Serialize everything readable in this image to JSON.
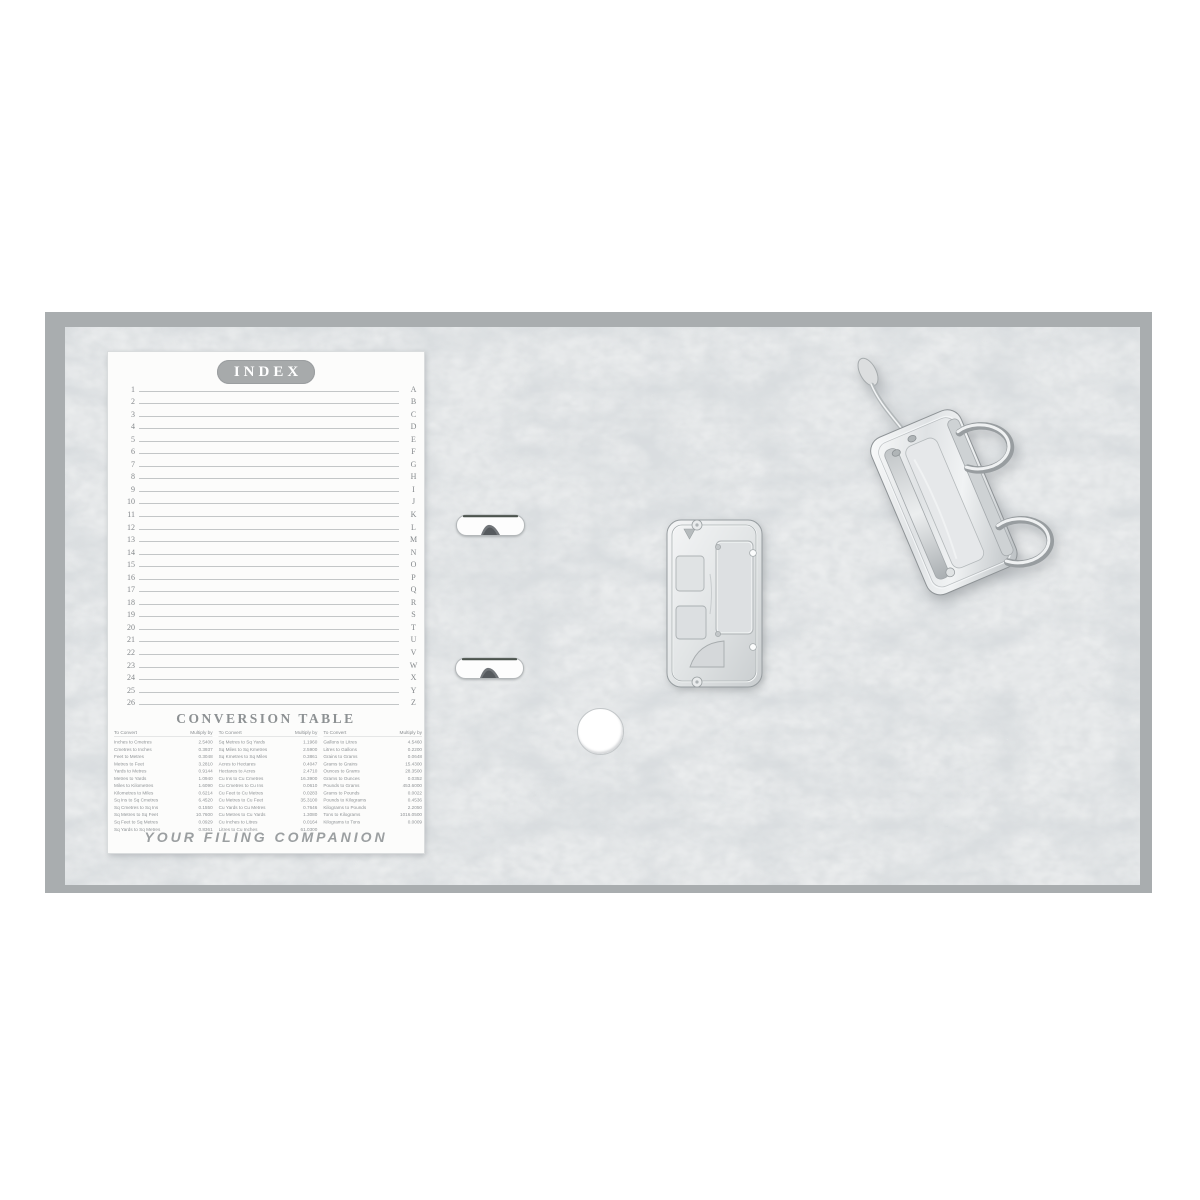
{
  "binder": {
    "index_card": {
      "title": "INDEX",
      "row_numbers": [
        "1",
        "2",
        "3",
        "4",
        "5",
        "6",
        "7",
        "8",
        "9",
        "10",
        "11",
        "12",
        "13",
        "14",
        "15",
        "16",
        "17",
        "18",
        "19",
        "20",
        "21",
        "22",
        "23",
        "24",
        "25",
        "26"
      ],
      "letters": [
        "A",
        "B",
        "C",
        "D",
        "E",
        "F",
        "G",
        "H",
        "I",
        "J",
        "K",
        "L",
        "M",
        "N",
        "O",
        "P",
        "Q",
        "R",
        "S",
        "T",
        "U",
        "V",
        "W",
        "X",
        "Y",
        "Z"
      ],
      "footer": "YOUR FILING COMPANION"
    },
    "conversion_table": {
      "title": "CONVERSION TABLE",
      "col_headers": {
        "convert": "To Convert",
        "multiply": "Multiply by"
      },
      "groups": [
        [
          {
            "label": "Inches to Cmetres",
            "value": "2.5400"
          },
          {
            "label": "Cmetres to Inches",
            "value": "0.3937"
          },
          {
            "label": "Feet to Metres",
            "value": "0.3048"
          },
          {
            "label": "Metres to Feet",
            "value": "3.2810"
          },
          {
            "label": "Yards to Metres",
            "value": "0.9144"
          },
          {
            "label": "Metres to Yards",
            "value": "1.0940"
          },
          {
            "label": "Miles to Kilometres",
            "value": "1.6090"
          },
          {
            "label": "Kilometres to Miles",
            "value": "0.6214"
          },
          {
            "label": "Sq Ins to Sq Cmetres",
            "value": "6.4520"
          },
          {
            "label": "Sq Cmetres to Sq Ins",
            "value": "0.1550"
          },
          {
            "label": "Sq Metres to Sq Feet",
            "value": "10.7600"
          },
          {
            "label": "Sq Feet to Sq Metres",
            "value": "0.0929"
          },
          {
            "label": "Sq Yards to Sq Metres",
            "value": "0.8361"
          }
        ],
        [
          {
            "label": "Sq Metres to Sq Yards",
            "value": "1.1960"
          },
          {
            "label": "Sq Miles to Sq Kmetres",
            "value": "2.5900"
          },
          {
            "label": "Sq Kmetres to Sq Miles",
            "value": "0.3861"
          },
          {
            "label": "Acres to Hectares",
            "value": "0.4047"
          },
          {
            "label": "Hectares to Acres",
            "value": "2.4710"
          },
          {
            "label": "Cu Ins to Cu Cmetres",
            "value": "16.3900"
          },
          {
            "label": "Cu Cmetres to Cu Ins",
            "value": "0.0610"
          },
          {
            "label": "Cu Feet to Cu Metres",
            "value": "0.0283"
          },
          {
            "label": "Cu Metres to Cu Feet",
            "value": "35.3100"
          },
          {
            "label": "Cu Yards to Cu Metres",
            "value": "0.7646"
          },
          {
            "label": "Cu Metres to Cu Yards",
            "value": "1.3080"
          },
          {
            "label": "Cu Inches to Litres",
            "value": "0.0164"
          },
          {
            "label": "Litres to Cu Inches",
            "value": "61.0300"
          }
        ],
        [
          {
            "label": "Gallons to Litres",
            "value": "4.5460"
          },
          {
            "label": "Litres to Gallons",
            "value": "0.2200"
          },
          {
            "label": "Grains to Grams",
            "value": "0.0648"
          },
          {
            "label": "Grams to Grains",
            "value": "15.4300"
          },
          {
            "label": "Ounces to Grams",
            "value": "28.3500"
          },
          {
            "label": "Grams to Ounces",
            "value": "0.0352"
          },
          {
            "label": "Pounds to Grams",
            "value": "453.6000"
          },
          {
            "label": "Grams to Pounds",
            "value": "0.0022"
          },
          {
            "label": "Pounds to Kilograms",
            "value": "0.4536"
          },
          {
            "label": "Kilograms to Pounds",
            "value": "2.2050"
          },
          {
            "label": "Tons to Kilograms",
            "value": "1016.0500"
          },
          {
            "label": "Kilograms to Tons",
            "value": "0.0009"
          }
        ]
      ]
    },
    "hardware": {
      "lever_arch_mechanism": "lever-arch-mechanism",
      "base_plate": "lever-arch-base-plate",
      "clips": "compressor-clip-slots",
      "finger_hole": "finger-hole"
    },
    "colors": {
      "board_edge": "#a9adaf",
      "board_texture_base": "#eaeced",
      "texture_veins": "#b3b8bb",
      "card_paper": "#fcfcfb",
      "badge_grey": "#a7aaab",
      "text_grey": "#8f9396",
      "metal_light": "#f2f4f5",
      "metal_dark": "#c7cbcd"
    }
  }
}
